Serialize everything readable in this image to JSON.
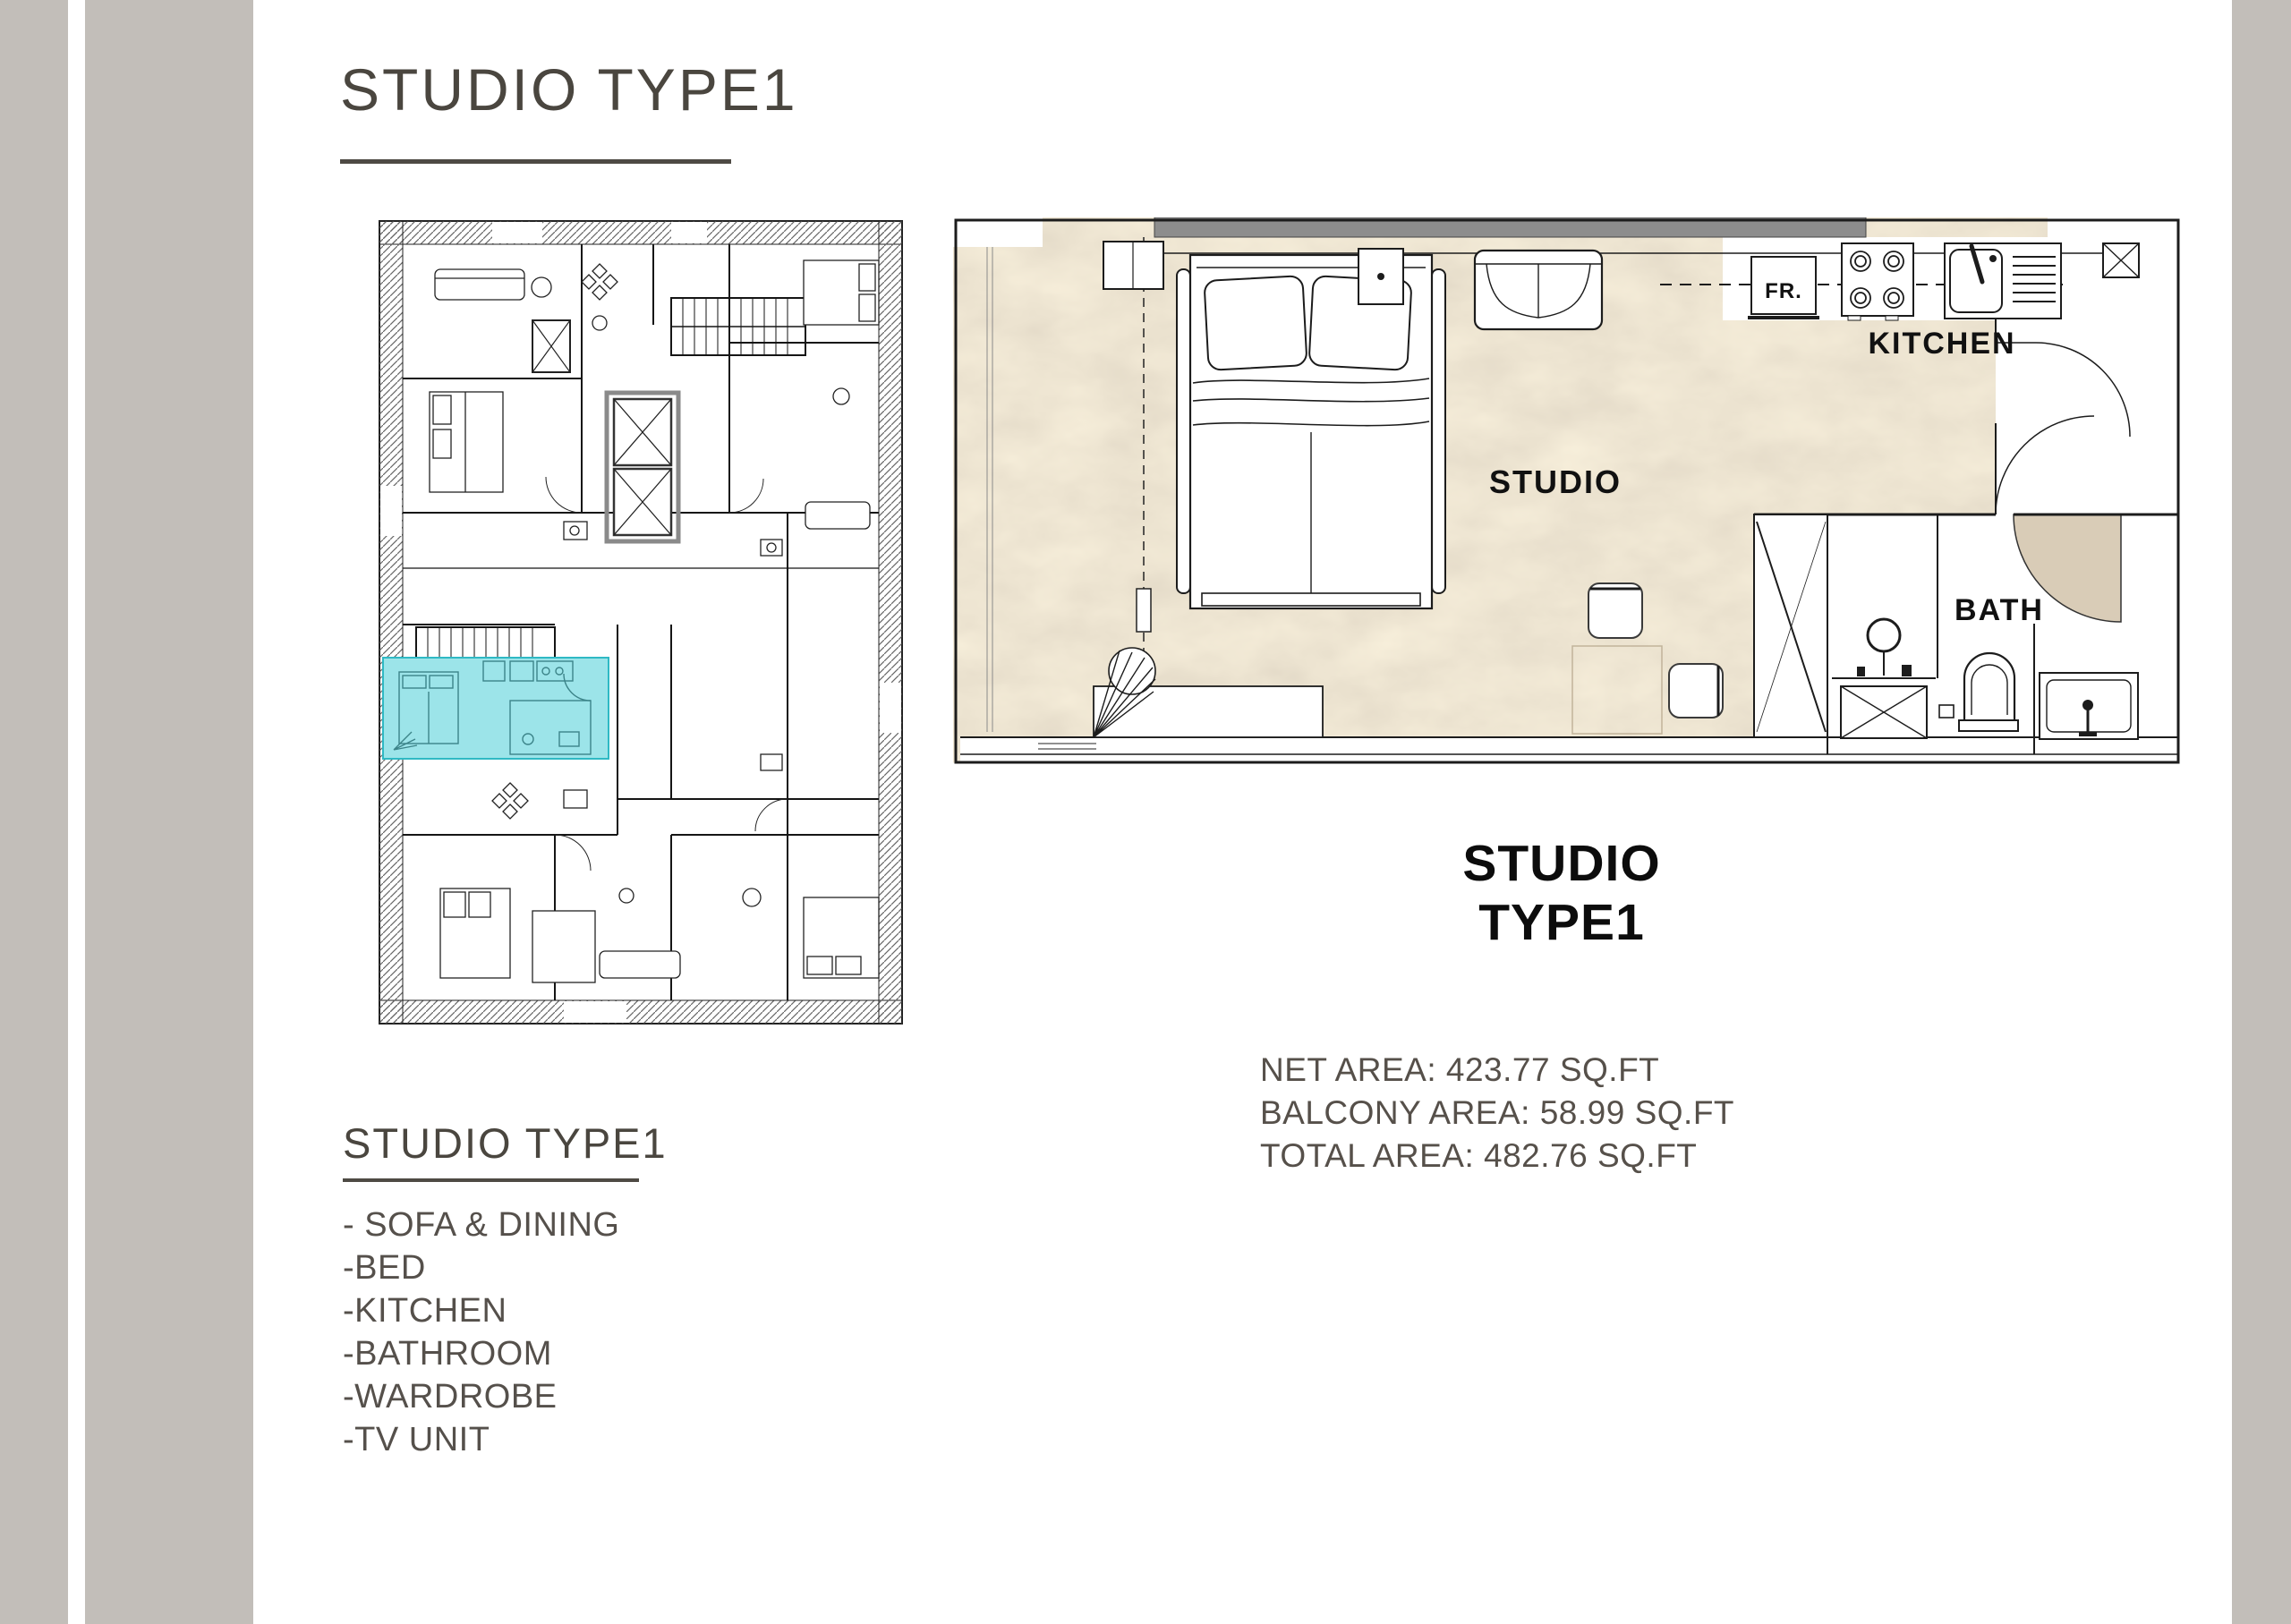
{
  "page": {
    "title": "STUDIO TYPE1"
  },
  "detail_plan": {
    "labels": {
      "fridge": "FR.",
      "kitchen": "KITCHEN",
      "studio": "STUDIO",
      "bath": "BATH"
    }
  },
  "unit_label": {
    "line1": "STUDIO",
    "line2": "TYPE1"
  },
  "areas": {
    "net": "NET AREA: 423.77 SQ.FT",
    "balcony": "BALCONY AREA: 58.99 SQ.FT",
    "total": "TOTAL AREA: 482.76 SQ.FT"
  },
  "features": {
    "heading": "STUDIO TYPE1",
    "items": [
      "- SOFA & DINING",
      "-BED",
      "-KITCHEN",
      "-BATHROOM",
      "-WARDROBE",
      "-TV UNIT"
    ]
  },
  "colors": {
    "side_strip": "#c2beb9",
    "heading_text": "#4a463f",
    "body_text": "#55504b",
    "highlight_cyan": "#5ad2da",
    "marble_beige": "#d9ccb7",
    "wall_gray_bar": "#8d8d8d"
  }
}
